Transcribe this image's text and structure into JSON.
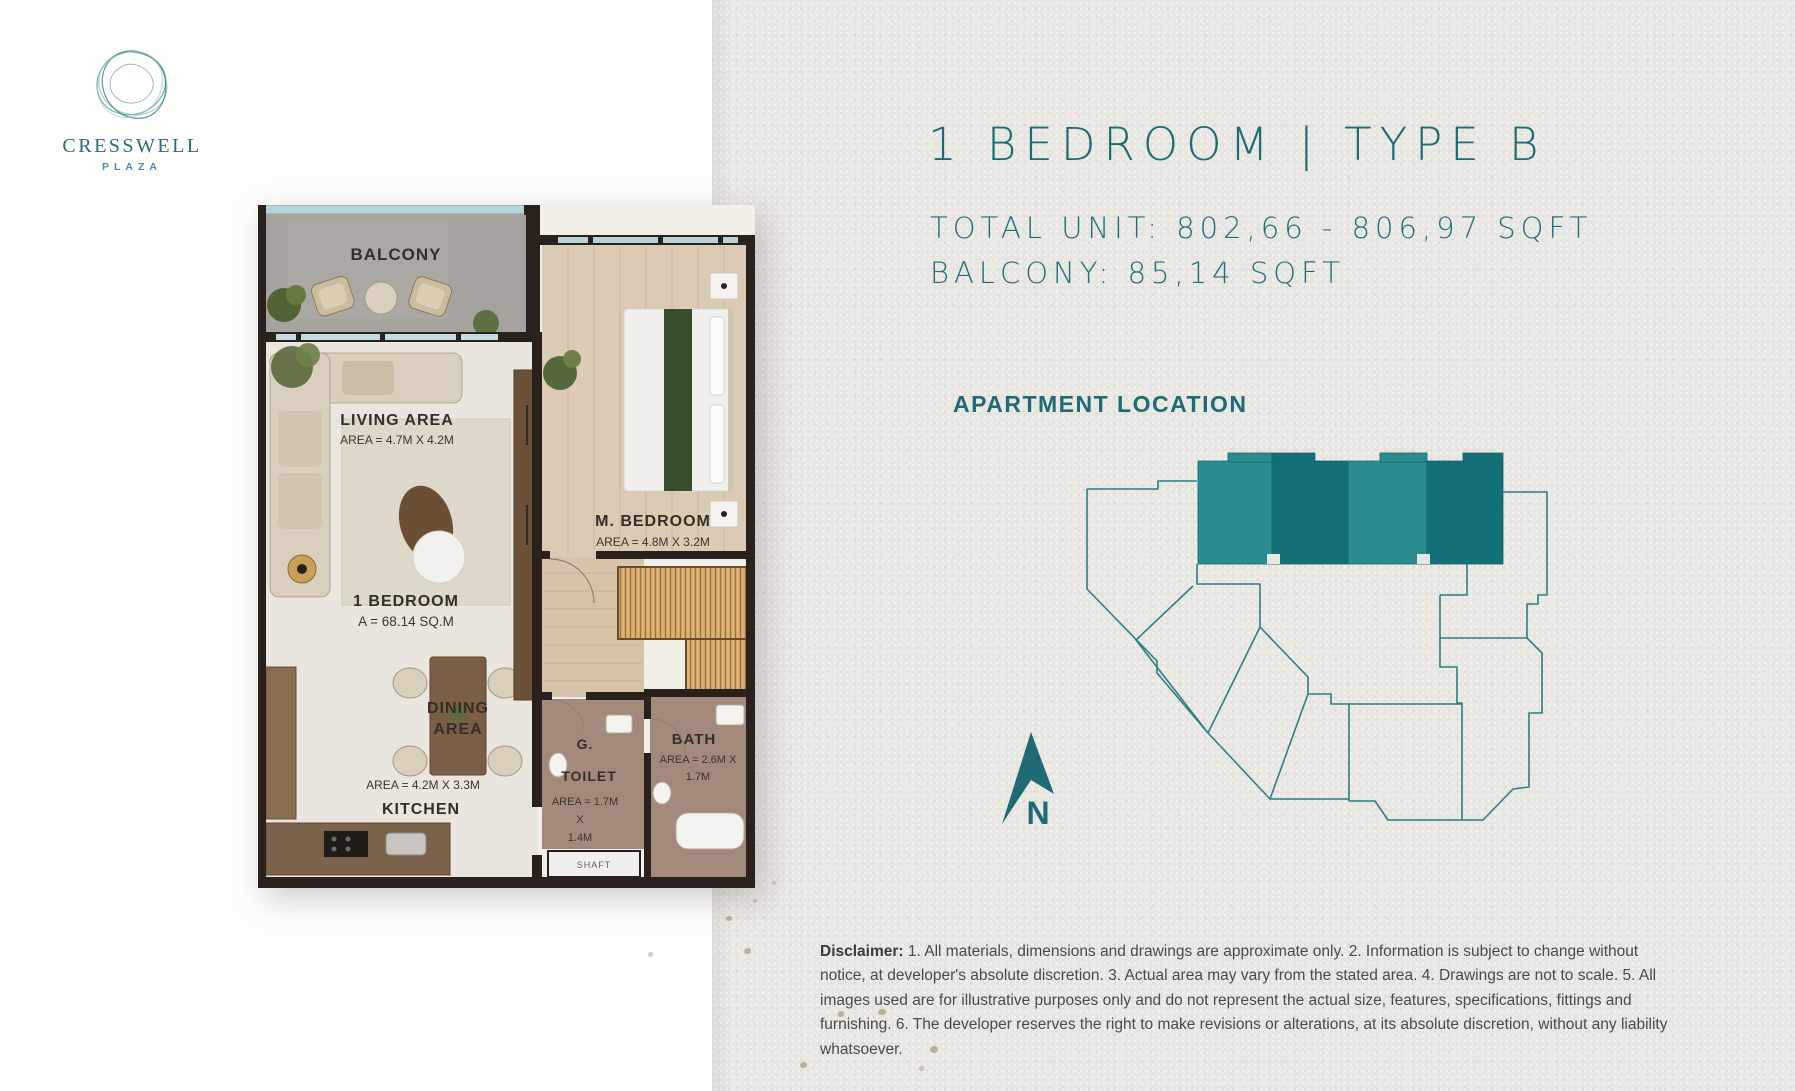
{
  "colors": {
    "teal_text": "#1d6b75",
    "unit_fill_light": "#2a8c91",
    "unit_fill_dark": "#156f79",
    "diagram_outline": "#2f7d88",
    "wall": "#2b211c",
    "right_background": "#e9e7e2"
  },
  "logo": {
    "name": "CRESSWELL",
    "subtitle": "PLAZA"
  },
  "header": {
    "title": "1 BEDROOM | TYPE B",
    "total_unit": "TOTAL UNIT: 802,66 - 806,97 SQFT",
    "balcony": "BALCONY: 85,14 SQFT"
  },
  "location": {
    "heading": "APARTMENT LOCATION",
    "compass": "N"
  },
  "floor_plan": {
    "balcony": "BALCONY",
    "living": {
      "name": "LIVING AREA",
      "area": "AREA = 4.7M X 4.2M"
    },
    "unit": {
      "name": "1 BEDROOM",
      "area": "A = 68.14 SQ.M"
    },
    "dining": {
      "line1": "DINING",
      "line2": "AREA",
      "area": "AREA = 4.2M X 3.3M"
    },
    "kitchen": "KITCHEN",
    "bedroom": {
      "name": "M. BEDROOM",
      "area": "AREA = 4.8M X 3.2M"
    },
    "toilet": {
      "line1": "G.",
      "line2": "TOILET",
      "area1": "AREA = 1.7M",
      "area2": "X",
      "area3": "1.4M"
    },
    "bath": {
      "name": "BATH",
      "area1": "AREA = 2.6M X",
      "area2": "1.7M"
    },
    "shaft": "SHAFT"
  },
  "disclaimer": {
    "label": "Disclaimer:",
    "text": " 1. All materials, dimensions and drawings are approximate only. 2. Information is subject to change without notice, at developer's absolute discretion. 3. Actual area may vary from the stated area. 4. Drawings are not to scale. 5. All images used are for illustrative purposes only and do not represent the actual size, features, specifications, fittings and furnishing. 6. The developer reserves the right to make revisions or alterations, at its absolute discretion, without any liability whatsoever."
  }
}
